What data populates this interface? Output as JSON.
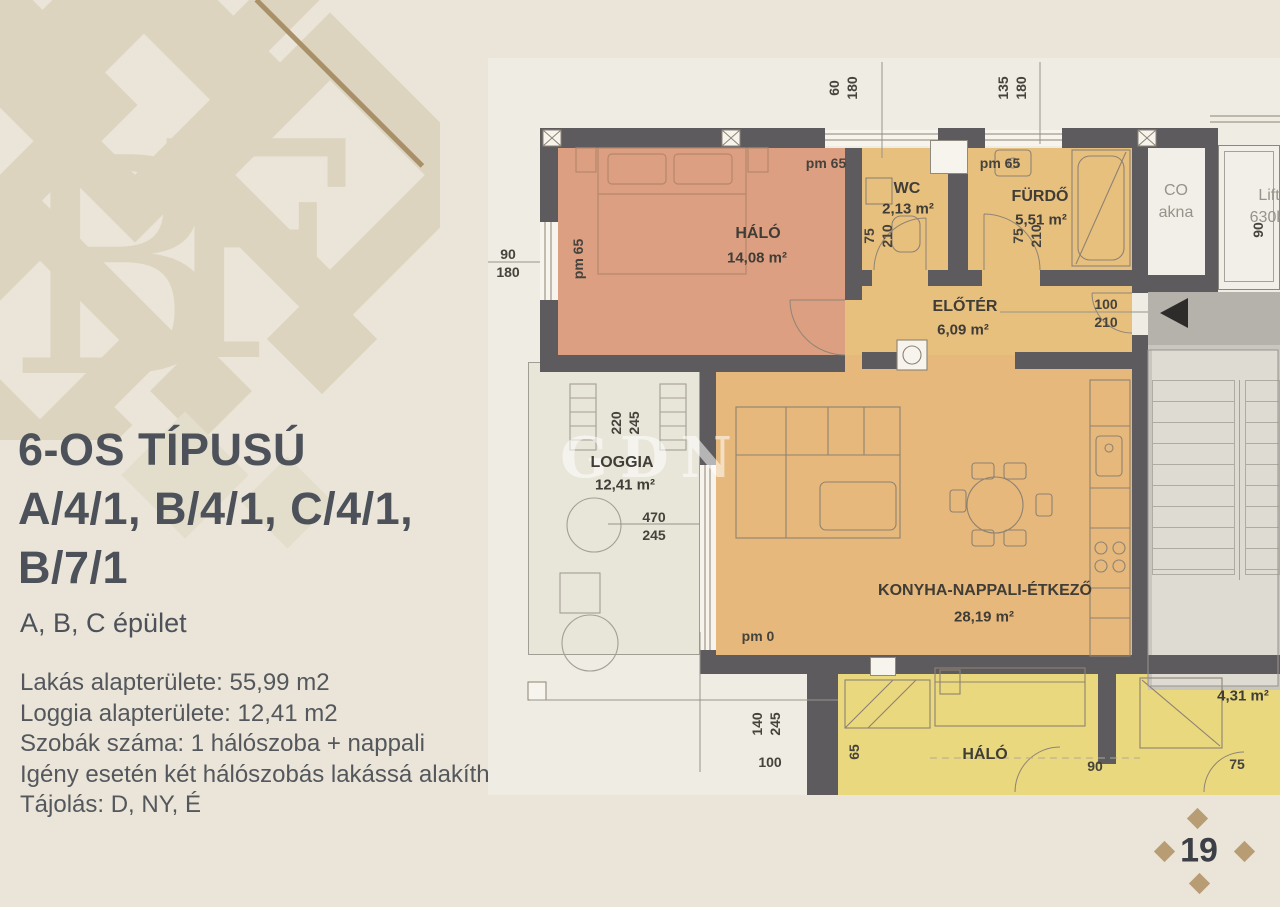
{
  "page": {
    "number": "19",
    "bg": "#eae5d8",
    "accent_tan": "#b89c74"
  },
  "logo": {
    "monogram_b": "B",
    "monogram_f": "F"
  },
  "left_panel": {
    "title_line1": "6-OS TÍPUSÚ",
    "title_line2": "A/4/1, B/4/1, C/4/1,",
    "title_line3": "B/7/1",
    "subtitle": "A, B, C épület",
    "details": {
      "line1": "Lakás alapterülete: 55,99 m2",
      "line2": "Loggia alapterülete: 12,41 m2",
      "line3": "Szobák száma:  1 hálószoba + nappali",
      "line4": "Igény esetén két hálószobás lakássá alakítható!",
      "line5": "Tájolás: D, NY, É"
    }
  },
  "plan": {
    "watermark": "GDN",
    "rooms": {
      "halo": {
        "name": "HÁLÓ",
        "area": "14,08 m²"
      },
      "wc": {
        "name": "WC",
        "area": "2,13 m²"
      },
      "furdo": {
        "name": "FÜRDŐ",
        "area": "5,51 m²"
      },
      "eloter": {
        "name": "ELŐTÉR",
        "area": "6,09 m²"
      },
      "konyha": {
        "name": "KONYHA-NAPPALI-ÉTKEZŐ",
        "area": "28,19 m²"
      },
      "loggia": {
        "name": "LOGGIA",
        "area": "12,41 m²"
      },
      "neighbor_halo": {
        "name": "HÁLÓ"
      },
      "neighbor_shower": {
        "area": "4,31 m²"
      },
      "shaft": {
        "line1": "CO",
        "line2": "akna"
      },
      "lift": {
        "line1": "Lift",
        "line2": "630k"
      }
    },
    "dims": {
      "top_win1": {
        "a": "60",
        "b": "180"
      },
      "top_win2": {
        "a": "135",
        "b": "180"
      },
      "left_win": {
        "a": "90",
        "b": "180"
      },
      "halo_pm_left": "pm 65",
      "halo_pm_top": "pm 65",
      "furdo_pm_top": "pm 65",
      "wc_door": {
        "a": "75",
        "b": "210"
      },
      "furdo_door": {
        "a": "75",
        "b": "210"
      },
      "entry_door": {
        "a": "100",
        "b": "210"
      },
      "lift_dim": "90",
      "loggia_win": {
        "a": "220",
        "b": "245"
      },
      "loggia_dim": {
        "a": "470",
        "b": "245"
      },
      "konyha_pm": "pm 0",
      "bottom_dim": {
        "a": "140",
        "b": "245"
      },
      "bottom_dim2": "100",
      "neighbor_left": "65",
      "neighbor_bottom": "90",
      "neighbor_door": "75"
    }
  }
}
